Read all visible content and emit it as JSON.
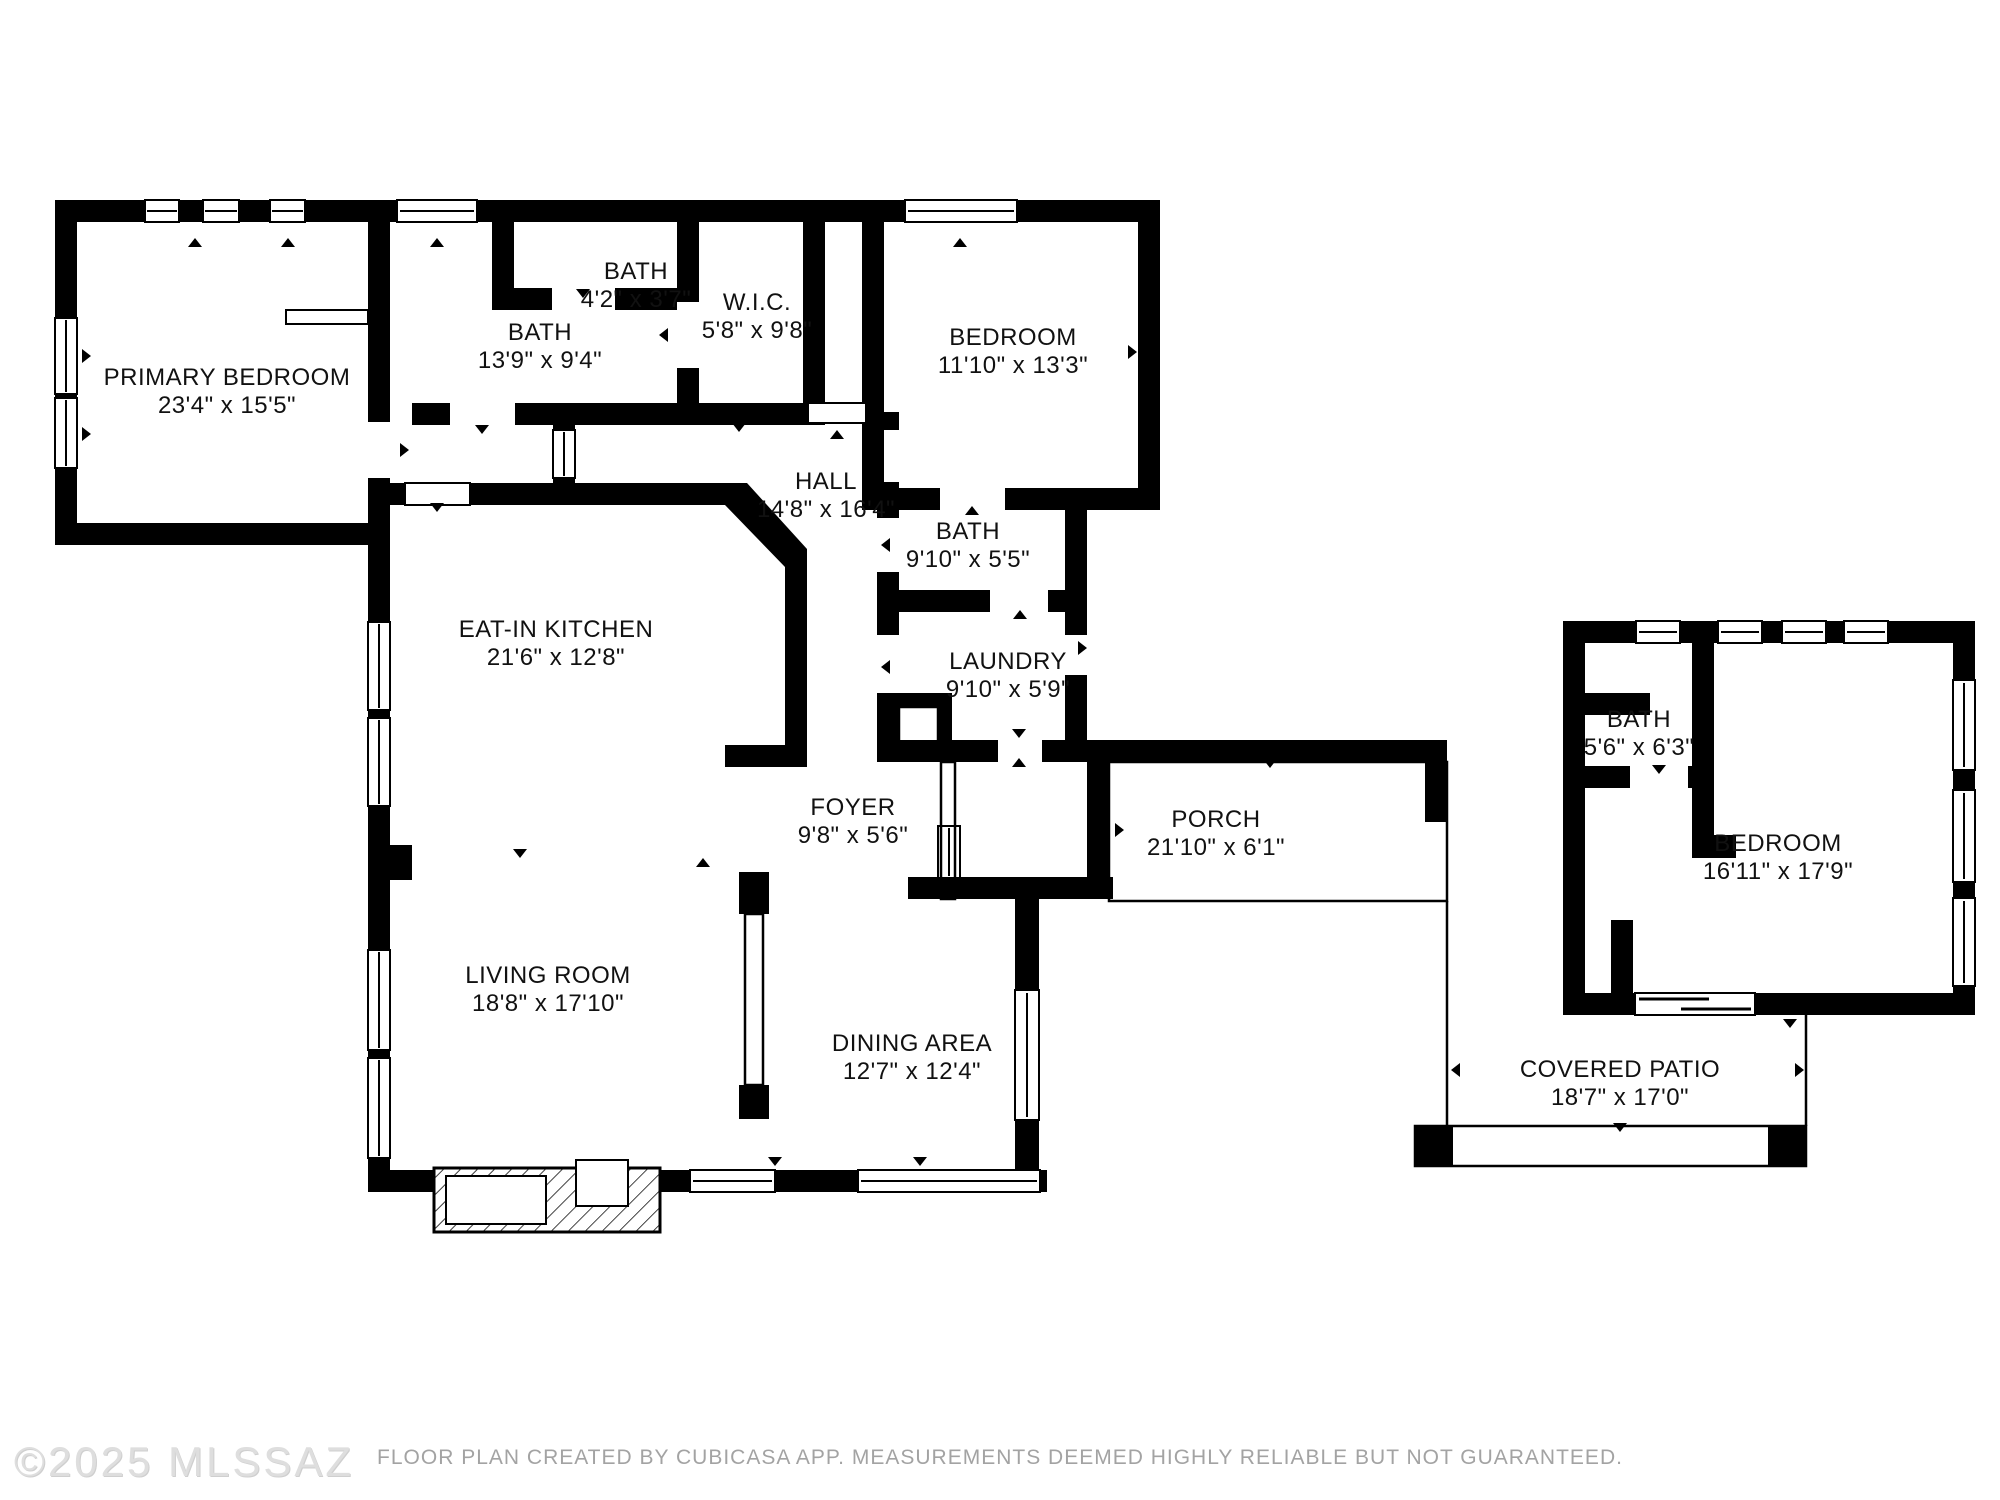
{
  "colors": {
    "background": "#ffffff",
    "wall": "#000000",
    "label_text": "#111111",
    "watermark": "#dedede",
    "disclaimer": "#a3a3a3"
  },
  "icons": {
    "window_symbol": "double-line window rectangle",
    "door_swing_marker": "▲",
    "fireplace_symbol": "diagonal-hatched hearth block"
  },
  "watermark": {
    "text": "©2025 MLSSAZ"
  },
  "footer": {
    "disclaimer": "FLOOR PLAN CREATED BY CUBICASA APP. MEASUREMENTS DEEMED HIGHLY RELIABLE BUT NOT GUARANTEED."
  },
  "plan": {
    "rooms": [
      {
        "id": "primary-bedroom",
        "name": "PRIMARY BEDROOM",
        "dims": "23'4\" x 15'5\""
      },
      {
        "id": "bath-upper",
        "name": "BATH",
        "dims": "13'9\" x 9'4\""
      },
      {
        "id": "bath-small",
        "name": "BATH",
        "dims": "4'2\" x 3'7\""
      },
      {
        "id": "walk-in-closet",
        "name": "W.I.C.",
        "dims": "5'8\" x 9'8\""
      },
      {
        "id": "bedroom-2",
        "name": "BEDROOM",
        "dims": "11'10\" x 13'3\""
      },
      {
        "id": "hall",
        "name": "HALL",
        "dims": "14'8\" x 16'4\""
      },
      {
        "id": "bath-hall",
        "name": "BATH",
        "dims": "9'10\" x 5'5\""
      },
      {
        "id": "laundry",
        "name": "LAUNDRY",
        "dims": "9'10\" x 5'9\""
      },
      {
        "id": "eat-in-kitchen",
        "name": "EAT-IN KITCHEN",
        "dims": "21'6\" x 12'8\""
      },
      {
        "id": "foyer",
        "name": "FOYER",
        "dims": "9'8\" x 5'6\""
      },
      {
        "id": "porch",
        "name": "PORCH",
        "dims": "21'10\" x 6'1\""
      },
      {
        "id": "living-room",
        "name": "LIVING ROOM",
        "dims": "18'8\" x 17'10\""
      },
      {
        "id": "dining-area",
        "name": "DINING AREA",
        "dims": "12'7\" x 12'4\""
      },
      {
        "id": "bath-casita",
        "name": "BATH",
        "dims": "5'6\" x 6'3\""
      },
      {
        "id": "bedroom-casita",
        "name": "BEDROOM",
        "dims": "16'11\" x 17'9\""
      },
      {
        "id": "covered-patio",
        "name": "COVERED PATIO",
        "dims": "18'7\" x 17'0\""
      }
    ]
  }
}
